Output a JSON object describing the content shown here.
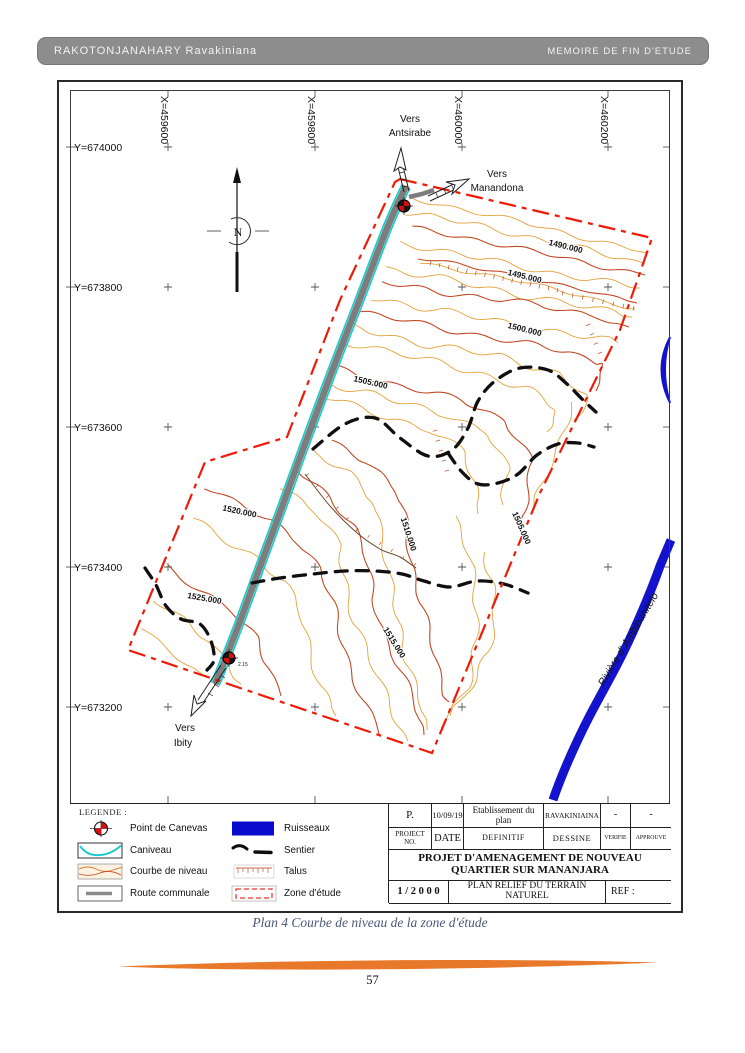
{
  "header": {
    "left": "RAKOTONJANAHARY Ravakiniana",
    "right": "MEMOIRE DE FIN D'ETUDE"
  },
  "map": {
    "x_labels": [
      "X=459600",
      "X=459800",
      "X=460000",
      "X=460200"
    ],
    "y_labels": [
      "Y=674000",
      "Y=673800",
      "Y=673600",
      "Y=673400",
      "Y=673200"
    ],
    "contour_labels": [
      "1490.000",
      "1495.000",
      "1500.000",
      "1505.000",
      "1505.000",
      "1510.000",
      "1515.000",
      "1520.000",
      "1525.000"
    ],
    "north_letter": "N",
    "vers": {
      "antsirabe": [
        "Vers",
        "Antsirabe"
      ],
      "manandona": [
        "Vers",
        "Manandona"
      ],
      "ibity": [
        "Vers",
        "Ibity"
      ]
    },
    "river_label": "Rivière d' Ambinanitelo",
    "survey_point_label": "2.15"
  },
  "legend": {
    "title": "LEGENDE :",
    "items_left": [
      "Point de Canevas",
      "Caniveau",
      "Courbe de niveau",
      "Route communale"
    ],
    "items_right": [
      "Ruisseaux",
      "Sentier",
      "Talus",
      "Zone d'étude"
    ]
  },
  "title_block": {
    "row1": [
      "P.",
      "10/09/19",
      "Etablissement du plan",
      "RAVAKINIAINA",
      "-",
      "-"
    ],
    "row2": [
      "PROJECT NO.",
      "DATE",
      "DEFINITIF",
      "DESSINE",
      "VERIFIE",
      "APPROUVE"
    ],
    "project_title": "PROJET D'AMENAGEMENT DE NOUVEAU QUARTIER SUR MANANJARA",
    "scale": "1 / 2 0 0 0",
    "plan_name": "PLAN RELIEF DU TERRAIN NATUREL",
    "ref": "REF :"
  },
  "caption": "Plan 4 Courbe de niveau de la zone d'étude",
  "page_number": "57",
  "colors": {
    "contour_light": "#E5A23C",
    "contour_dark": "#C24A26",
    "boundary_red": "#ED1C09",
    "river_blue": "#1313CE",
    "canal_cyan": "#1ECBCB",
    "road_gray": "#7d7d7d",
    "divider_orange": "#E8782A",
    "caption_blue": "#4a5777",
    "header_gray": "#8d8d8d"
  }
}
